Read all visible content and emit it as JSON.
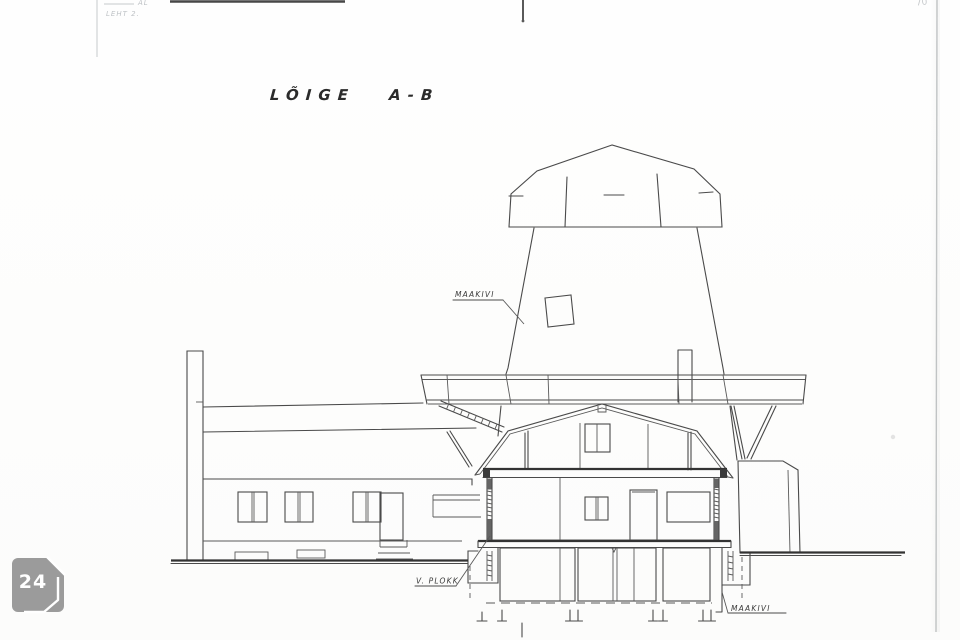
{
  "scan": {
    "header_note_line1": "AL",
    "header_note_line2": "LEHT 2.",
    "corner_mark": "70"
  },
  "drawing": {
    "title": "LÕIGE A-B",
    "labels": {
      "tower_wall_material": "MAAKIVI",
      "basement_wall": "V. PLOKK",
      "foundation_material": "MAAKIVI"
    }
  },
  "badge": {
    "count": "24"
  }
}
